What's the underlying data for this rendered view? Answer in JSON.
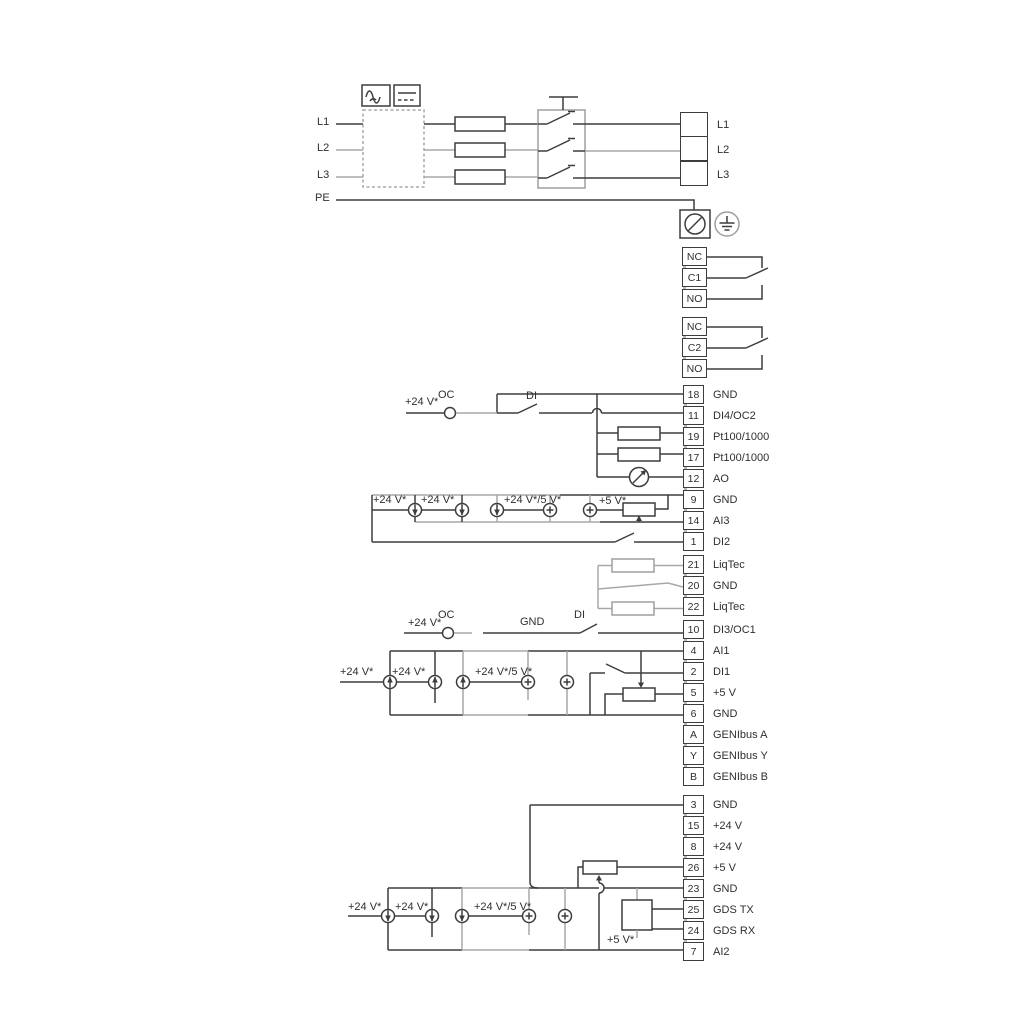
{
  "labels": {
    "l1": "L1",
    "l2": "L2",
    "l3": "L3",
    "pe": "PE",
    "plus24": "+24 V*",
    "plus5": "+5 V*",
    "plus24or5": "+24 V*/5 V*",
    "oc": "OC",
    "di": "DI",
    "gnd": "GND"
  },
  "colors": {
    "ink": "#3d3d3d",
    "soft": "#a8a8a8"
  },
  "blocks": [
    {
      "id": "power",
      "rows": [
        {
          "num": "",
          "label": "L1"
        },
        {
          "num": "",
          "label": "L2"
        },
        {
          "num": "",
          "label": "L3"
        }
      ]
    },
    {
      "id": "relay1",
      "rows": [
        {
          "num": "NC",
          "label": ""
        },
        {
          "num": "C1",
          "label": ""
        },
        {
          "num": "NO",
          "label": ""
        }
      ]
    },
    {
      "id": "relay2",
      "rows": [
        {
          "num": "NC",
          "label": ""
        },
        {
          "num": "C2",
          "label": ""
        },
        {
          "num": "NO",
          "label": ""
        }
      ]
    },
    {
      "id": "io-upper",
      "rows": [
        {
          "num": "18",
          "label": "GND"
        },
        {
          "num": "11",
          "label": "DI4/OC2"
        },
        {
          "num": "19",
          "label": "Pt100/1000"
        },
        {
          "num": "17",
          "label": "Pt100/1000"
        },
        {
          "num": "12",
          "label": "AO"
        },
        {
          "num": "9",
          "label": "GND"
        },
        {
          "num": "14",
          "label": "AI3"
        },
        {
          "num": "1",
          "label": "DI2"
        }
      ]
    },
    {
      "id": "liqtec",
      "rows": [
        {
          "num": "21",
          "label": "LiqTec"
        },
        {
          "num": "20",
          "label": "GND"
        },
        {
          "num": "22",
          "label": "LiqTec"
        }
      ]
    },
    {
      "id": "io-mid",
      "rows": [
        {
          "num": "10",
          "label": "DI3/OC1"
        },
        {
          "num": "4",
          "label": "AI1"
        },
        {
          "num": "2",
          "label": "DI1"
        },
        {
          "num": "5",
          "label": "+5 V"
        },
        {
          "num": "6",
          "label": "GND"
        },
        {
          "num": "A",
          "label": "GENIbus A"
        },
        {
          "num": "Y",
          "label": "GENIbus Y"
        },
        {
          "num": "B",
          "label": "GENIbus B"
        }
      ]
    },
    {
      "id": "io-lower",
      "rows": [
        {
          "num": "3",
          "label": "GND"
        },
        {
          "num": "15",
          "label": "+24 V"
        },
        {
          "num": "8",
          "label": "+24 V"
        },
        {
          "num": "26",
          "label": "+5 V"
        },
        {
          "num": "23",
          "label": "GND"
        },
        {
          "num": "25",
          "label": "GDS TX"
        },
        {
          "num": "24",
          "label": "GDS RX"
        },
        {
          "num": "7",
          "label": "AI2"
        }
      ]
    }
  ]
}
